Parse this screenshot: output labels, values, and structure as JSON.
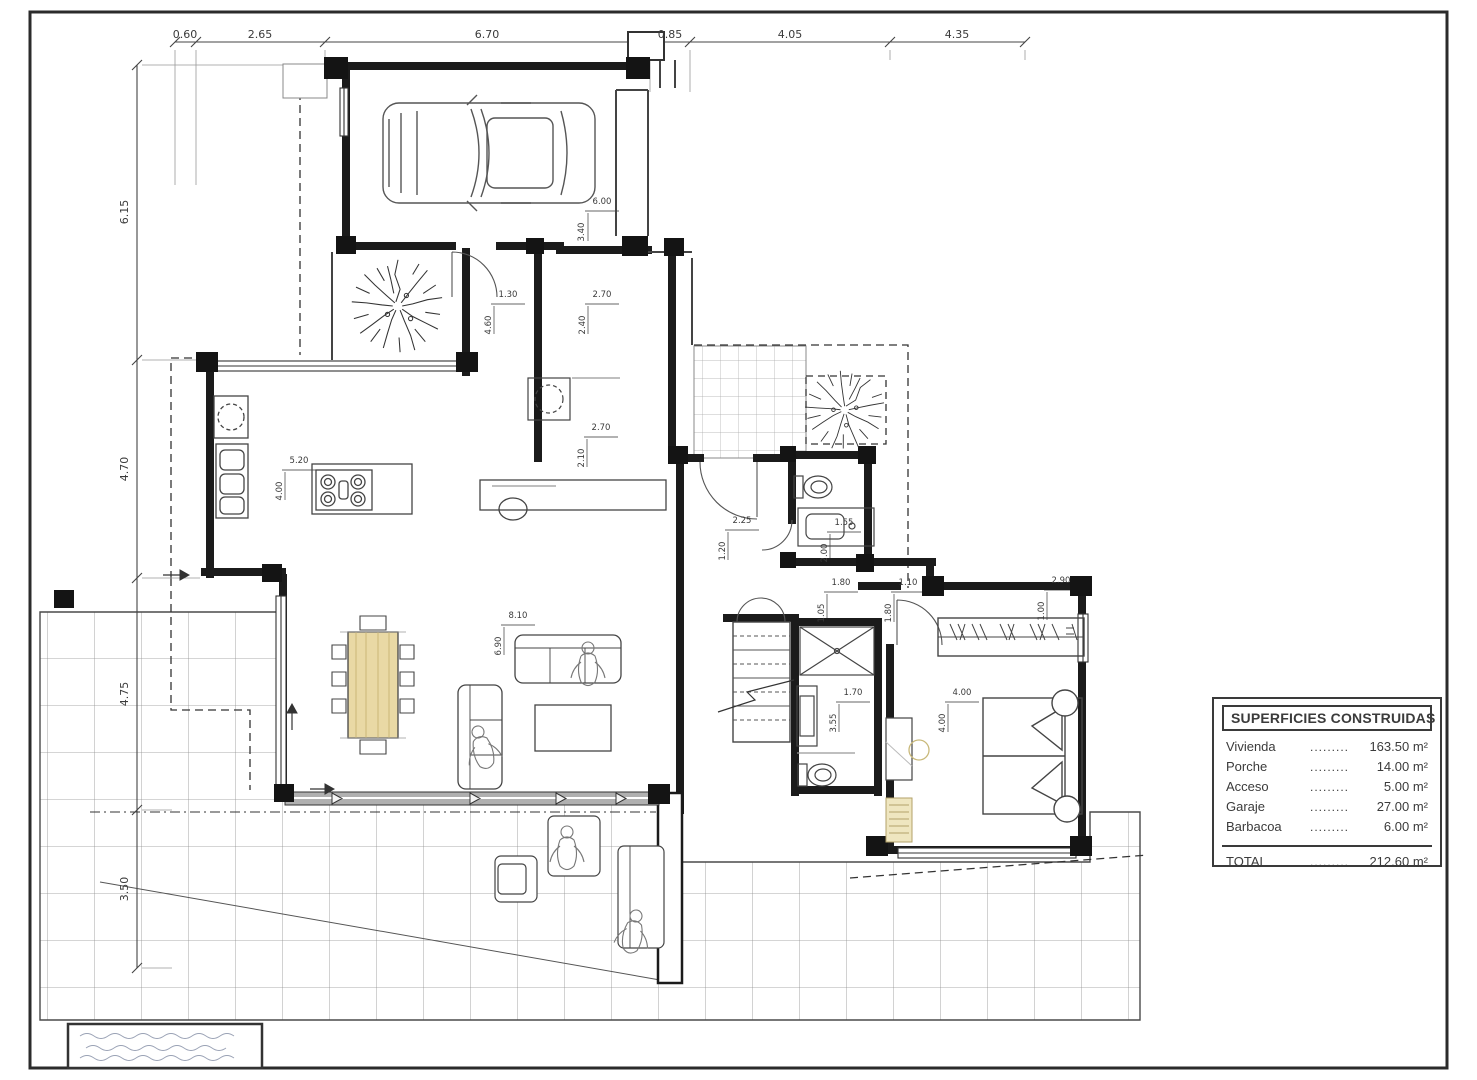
{
  "legend": {
    "title": "SUPERFICIES CONSTRUIDAS",
    "dots": "............",
    "rows": [
      {
        "label": "Vivienda",
        "value": "163.50 m²"
      },
      {
        "label": "Porche",
        "value": "14.00 m²"
      },
      {
        "label": "Acceso",
        "value": "5.00 m²"
      },
      {
        "label": "Garaje",
        "value": "27.00 m²"
      },
      {
        "label": "Barbacoa",
        "value": "6.00 m²"
      }
    ],
    "total": {
      "label": "TOTAL",
      "value": "212.60 m²"
    }
  },
  "dims": {
    "top": [
      {
        "t": "0.60",
        "x": 185
      },
      {
        "t": "2.65",
        "x": 260
      },
      {
        "t": "6.70",
        "x": 487
      },
      {
        "t": "0.85",
        "x": 670
      },
      {
        "t": "4.05",
        "x": 790
      },
      {
        "t": "4.35",
        "x": 957
      }
    ],
    "left": [
      {
        "t": "6.15",
        "y": 212
      },
      {
        "t": "4.70",
        "y": 469
      },
      {
        "t": "4.75",
        "y": 694
      },
      {
        "t": "3.50",
        "y": 889
      }
    ],
    "interior": [
      {
        "t": "6.00",
        "x": 602,
        "y": 204,
        "r": 0
      },
      {
        "t": "3.40",
        "x": 584,
        "y": 232,
        "r": 1
      },
      {
        "t": "2.70",
        "x": 602,
        "y": 297,
        "r": 0
      },
      {
        "t": "2.40",
        "x": 585,
        "y": 325,
        "r": 1
      },
      {
        "t": "1.30",
        "x": 508,
        "y": 297,
        "r": 0
      },
      {
        "t": "4.60",
        "x": 491,
        "y": 325,
        "r": 1
      },
      {
        "t": "5.20",
        "x": 299,
        "y": 463,
        "r": 0
      },
      {
        "t": "4.00",
        "x": 282,
        "y": 491,
        "r": 1
      },
      {
        "t": "2.70",
        "x": 601,
        "y": 430,
        "r": 0
      },
      {
        "t": "2.10",
        "x": 584,
        "y": 458,
        "r": 1
      },
      {
        "t": "2.25",
        "x": 742,
        "y": 523,
        "r": 0
      },
      {
        "t": "1.20",
        "x": 725,
        "y": 551,
        "r": 1
      },
      {
        "t": "1.55",
        "x": 844,
        "y": 525,
        "r": 0
      },
      {
        "t": "2.00",
        "x": 827,
        "y": 553,
        "r": 1
      },
      {
        "t": "1.80",
        "x": 841,
        "y": 585,
        "r": 0
      },
      {
        "t": "1.05",
        "x": 824,
        "y": 613,
        "r": 1
      },
      {
        "t": "1.10",
        "x": 908,
        "y": 585,
        "r": 0
      },
      {
        "t": "1.80",
        "x": 891,
        "y": 613,
        "r": 1
      },
      {
        "t": "2.90",
        "x": 1061,
        "y": 583,
        "r": 0
      },
      {
        "t": "1.00",
        "x": 1044,
        "y": 611,
        "r": 1
      },
      {
        "t": "8.10",
        "x": 518,
        "y": 618,
        "r": 0
      },
      {
        "t": "6.90",
        "x": 501,
        "y": 646,
        "r": 1
      },
      {
        "t": "1.70",
        "x": 853,
        "y": 695,
        "r": 0
      },
      {
        "t": "3.55",
        "x": 836,
        "y": 723,
        "r": 1
      },
      {
        "t": "4.00",
        "x": 962,
        "y": 695,
        "r": 0
      },
      {
        "t": "4.00",
        "x": 945,
        "y": 723,
        "r": 1
      }
    ]
  },
  "colors": {
    "paper": "#ffffff",
    "sheet_border": "#2b2b2b",
    "wall": "#1b1b1b",
    "thin_line": "#555555",
    "grid": "#8f8f8f",
    "wood": "#e9d9a5",
    "beige": "#efe6c0"
  }
}
